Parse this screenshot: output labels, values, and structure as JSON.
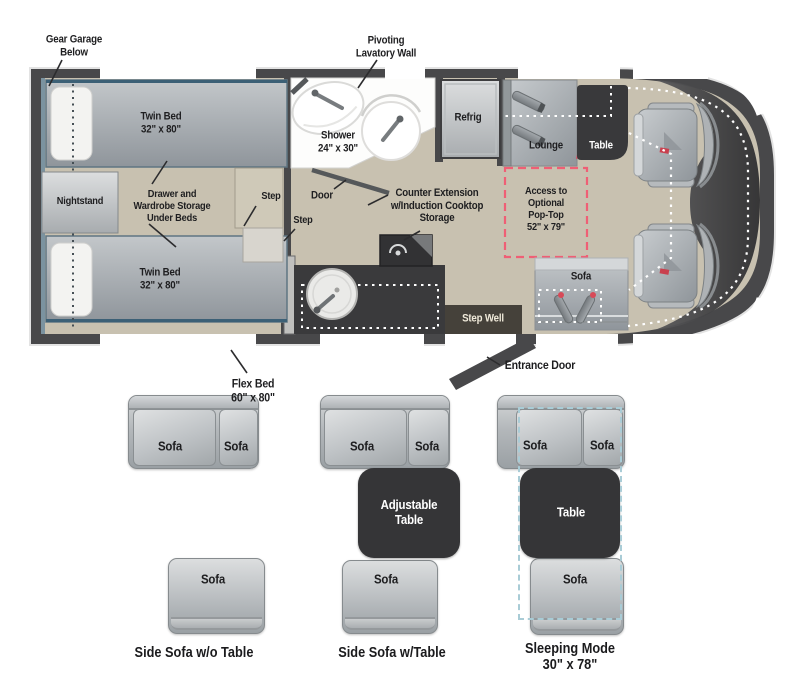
{
  "floorplan": {
    "callouts": {
      "gear_garage": "Gear Garage\nBelow",
      "pivoting_lavatory": "Pivoting\nLavatory Wall",
      "flex_bed": "Flex Bed\n60\" x 80\"",
      "entrance_door": "Entrance Door"
    },
    "rooms": {
      "twin_bed_top": "Twin Bed\n32\" x 80\"",
      "twin_bed_bottom": "Twin Bed\n32\" x 80\"",
      "nightstand": "Nightstand",
      "storage": "Drawer and\nWardrobe Storage\nUnder Beds",
      "step_upper": "Step",
      "step_lower": "Step",
      "shower": "Shower\n24\" x 30\"",
      "door": "Door",
      "refrig": "Refrig",
      "counter_extension": "Counter Extension\nw/Induction Cooktop\nStorage",
      "lounge": "Lounge",
      "table": "Table",
      "pop_top": "Access to\nOptional\nPop-Top\n52\" x 79\"",
      "sofa": "Sofa",
      "step_well": "Step Well"
    }
  },
  "configurations": [
    {
      "caption": "Side Sofa w/o Table",
      "sofa_left": "Sofa",
      "sofa_right": "Sofa",
      "sofa_single": "Sofa"
    },
    {
      "caption": "Side Sofa w/Table",
      "sofa_left": "Sofa",
      "sofa_right": "Sofa",
      "table": "Adjustable\nTable",
      "sofa_single": "Sofa"
    },
    {
      "caption": "Sleeping Mode\n30\" x 78\"",
      "sofa_left": "Sofa",
      "sofa_right": "Sofa",
      "table": "Table",
      "sofa_single": "Sofa"
    }
  ],
  "colors": {
    "wall": "#48484a",
    "floor": "#c8c1b0",
    "furniture_dark": "#353537",
    "pop_top_dashed": "#ef5f75",
    "sleeping_mode_dashed": "#a9ccd6"
  }
}
